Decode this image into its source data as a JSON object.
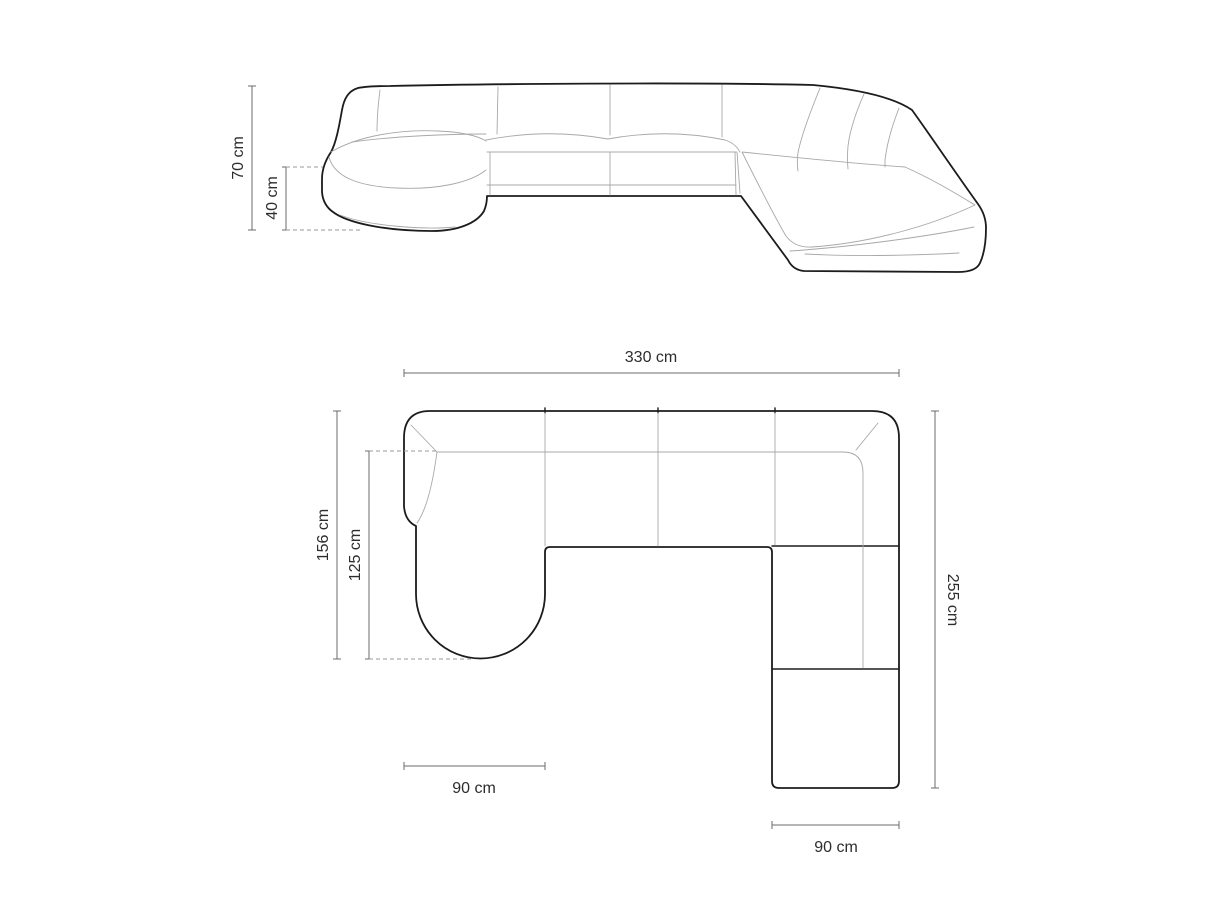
{
  "canvas": {
    "width": 1214,
    "height": 911,
    "background": "#ffffff"
  },
  "colors": {
    "outline": "#1c1c1c",
    "seam": "#a8a8a8",
    "dimension_line": "#6b6b6b",
    "label_text": "#2d2d2d",
    "dashed_guide": "#9a9a9a"
  },
  "elevation_view": {
    "name": "front-elevation-view",
    "labels": {
      "total_height": "70 cm",
      "seat_height": "40 cm"
    }
  },
  "plan_view": {
    "name": "top-plan-view",
    "labels": {
      "total_width": "330 cm",
      "left_depth": "156 cm",
      "chaise_length": "125 cm",
      "chaise_width": "90 cm",
      "right_depth": "255 cm",
      "ottoman_width": "90 cm"
    }
  }
}
